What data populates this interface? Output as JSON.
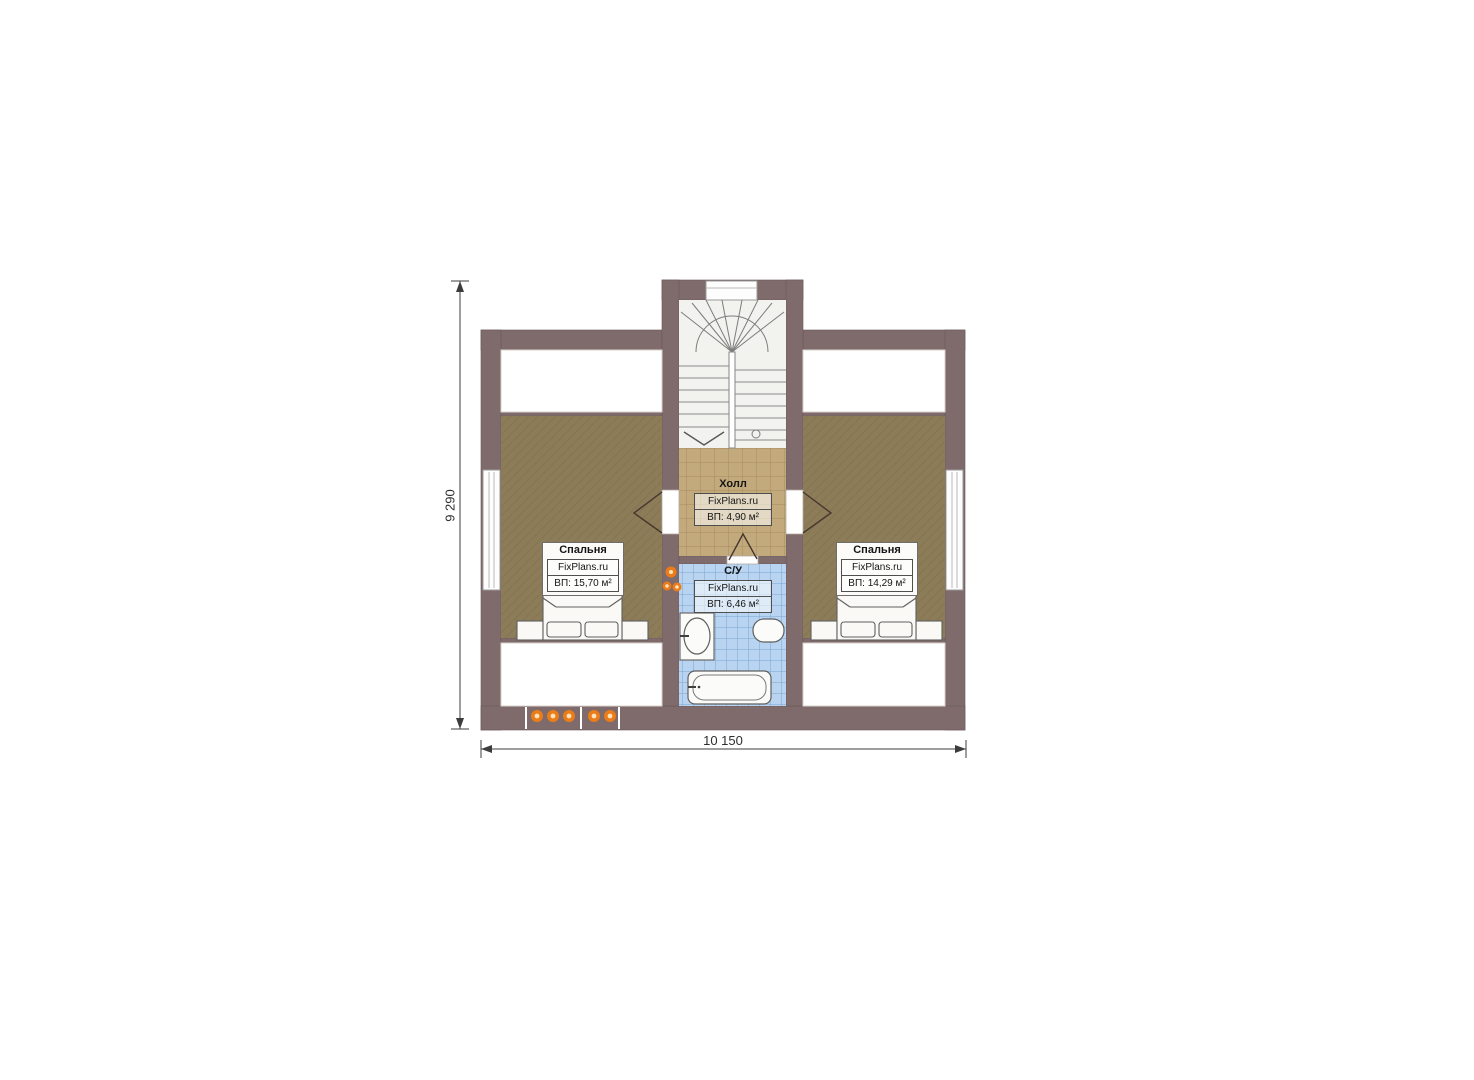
{
  "plan": {
    "title": "attic-floor-plan",
    "dimensions": {
      "height": "9 290",
      "width": "10 150"
    },
    "rooms": {
      "bedroom_left": {
        "name": "Спальня",
        "watermark": "FixPlans.ru",
        "area": "ВП: 15,70 м²"
      },
      "bedroom_right": {
        "name": "Спальня",
        "watermark": "FixPlans.ru",
        "area": "ВП: 14,29 м²"
      },
      "hall": {
        "name": "Холл",
        "watermark": "FixPlans.ru",
        "area": "ВП: 4,90 м²"
      },
      "bathroom": {
        "name": "С/У",
        "watermark": "FixPlans.ru",
        "area": "ВП: 6,46 м²"
      }
    },
    "colors": {
      "wall": "#7f6b6b",
      "bedroom_floor": "#8d7c58",
      "hall_floor": "#c3aa7d",
      "bath_floor": "#b8d4f0",
      "stair_floor": "#f2f2ef",
      "light_accent": "#ec7c17"
    }
  }
}
